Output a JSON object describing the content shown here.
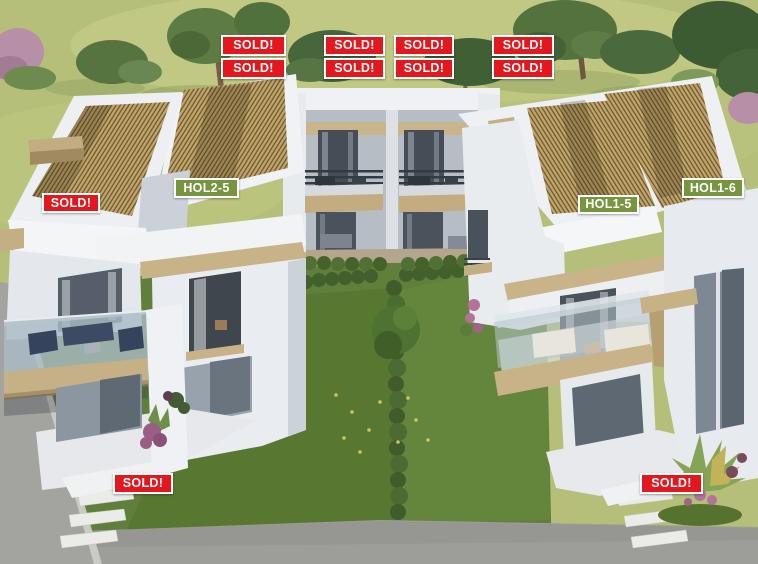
{
  "badges": {
    "items": [
      {
        "text": "SOLD!",
        "status": "sold"
      },
      {
        "text": "SOLD!",
        "status": "sold"
      },
      {
        "text": "SOLD!",
        "status": "sold"
      },
      {
        "text": "SOLD!",
        "status": "sold"
      },
      {
        "text": "SOLD!",
        "status": "sold"
      },
      {
        "text": "SOLD!",
        "status": "sold"
      },
      {
        "text": "SOLD!",
        "status": "sold"
      },
      {
        "text": "SOLD!",
        "status": "sold"
      },
      {
        "text": "SOLD!",
        "status": "sold"
      },
      {
        "text": "HOL2-5",
        "status": "available"
      },
      {
        "text": "HOL1-5",
        "status": "available"
      },
      {
        "text": "HOL1-6",
        "status": "available"
      },
      {
        "text": "SOLD!",
        "status": "sold"
      },
      {
        "text": "SOLD!",
        "status": "sold"
      }
    ]
  },
  "colors": {
    "sold-bg": "#e3171e",
    "available-bg": "#77953f",
    "badge-text": "#ffffff",
    "badge-border": "#ffffff",
    "roof-tile": "#c0a566",
    "accent-trim": "#c8b288",
    "lawn": "#b5bf79",
    "garden": "#5f7f3a",
    "pavement": "#9d9d99"
  }
}
